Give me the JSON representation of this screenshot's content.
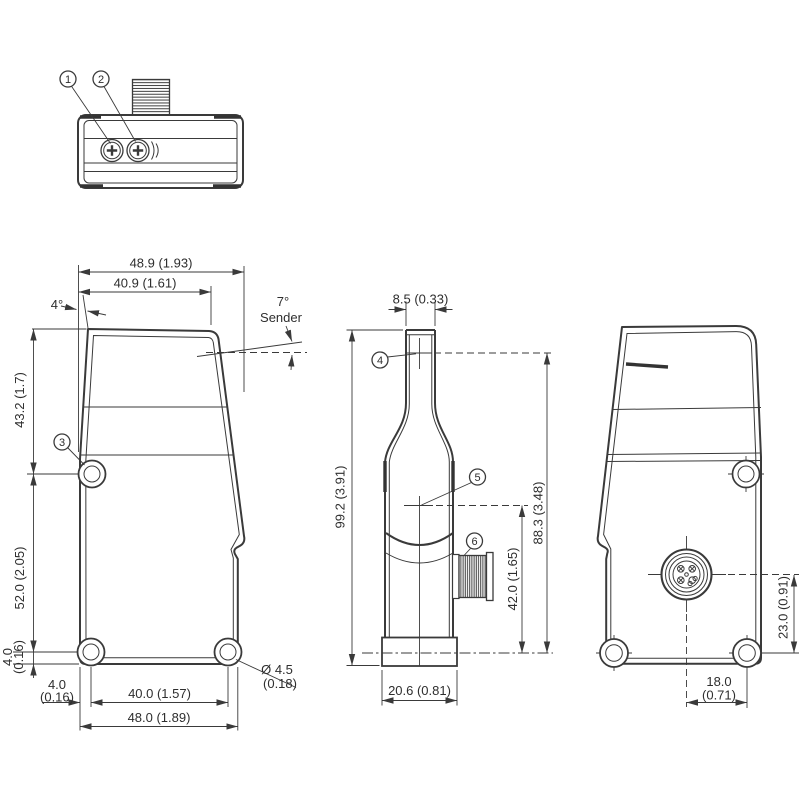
{
  "drawing": {
    "callouts": {
      "c1": "1",
      "c2": "2",
      "c3": "3",
      "c4": "4",
      "c5": "5",
      "c6": "6"
    },
    "front": {
      "width_overall": "48.9 (1.93)",
      "width_top": "40.9 (1.61)",
      "angle_housing": "4°",
      "angle_sender": "7°",
      "sender_label": "Sender",
      "height_upper": "43.2 (1.7)",
      "height_holes": "52.0 (2.05)",
      "offset_bottom_mm": "4.0",
      "offset_bottom_in": "(0.16)",
      "offset_side_mm": "4.0",
      "offset_side_in": "(0.16)",
      "width_holes": "40.0 (1.57)",
      "width_base": "48.0 (1.89)",
      "hole_dia_mm": "Ø 4.5",
      "hole_dia_in": "(0.18)"
    },
    "side": {
      "width_neck": "8.5 (0.33)",
      "height_overall": "99.2 (3.91)",
      "height_axis_top": "88.3 (3.48)",
      "height_connector": "42.0 (1.65)",
      "depth_base": "20.6 (0.81)"
    },
    "back": {
      "connector_offset": "23.0 (0.91)",
      "hole_offset_mm": "18.0",
      "hole_offset_in": "(0.71)"
    }
  }
}
